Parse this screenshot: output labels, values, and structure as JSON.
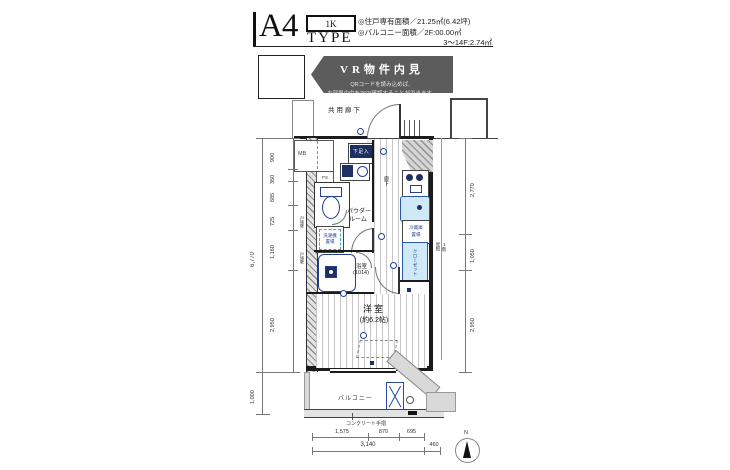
{
  "header": {
    "plan_type": "A4",
    "plan_type_suffix": "TYPE",
    "layout": "1K",
    "area_line1": "◎住戸専有面積／21.25㎡(6.42坪)",
    "area_line2": "◎バルコニー面積／2F:00.00㎡",
    "area_line3": "3〜14F:2.74㎡"
  },
  "vr": {
    "title": "VR物件内見",
    "desc1": "QRコードを読み込めば、",
    "desc2": "お部屋の中を360°確認することができます。"
  },
  "plan": {
    "common_corridor": "共用廊下",
    "entrance": "玄関",
    "shoe_box": "下足入",
    "meter_box": "MB",
    "pipe_space": "PS",
    "hallway": "廊下",
    "powder_room_line1": "パウダー",
    "powder_room_line2": "ルーム",
    "washer_line1": "洗濯機",
    "washer_line2": "置場",
    "bathroom_line1": "浴室",
    "bathroom_line2": "(1014)",
    "fridge_line1": "冷蔵庫",
    "fridge_line2": "置場",
    "closet": "クローゼット",
    "room_name": "洋室",
    "room_size": "(約6.2帖)",
    "balcony": "バルコニー",
    "handrail": "コンクリート手摺",
    "party_wall": "戸境壁",
    "roof_note_line1": "1階",
    "roof_note_line2": "屋根",
    "compass_n": "N"
  },
  "dimensions": {
    "left_total": "6,770",
    "left_segments": [
      "900",
      "350",
      "685",
      "725",
      "1,160",
      "2,950"
    ],
    "balcony_depth": "1,000",
    "right_segments": [
      "2,770",
      "1,050",
      "2,950"
    ],
    "bottom_segments": [
      "1,575",
      "870",
      "695"
    ],
    "bottom_total": "3,140",
    "bottom_extra": "460"
  }
}
